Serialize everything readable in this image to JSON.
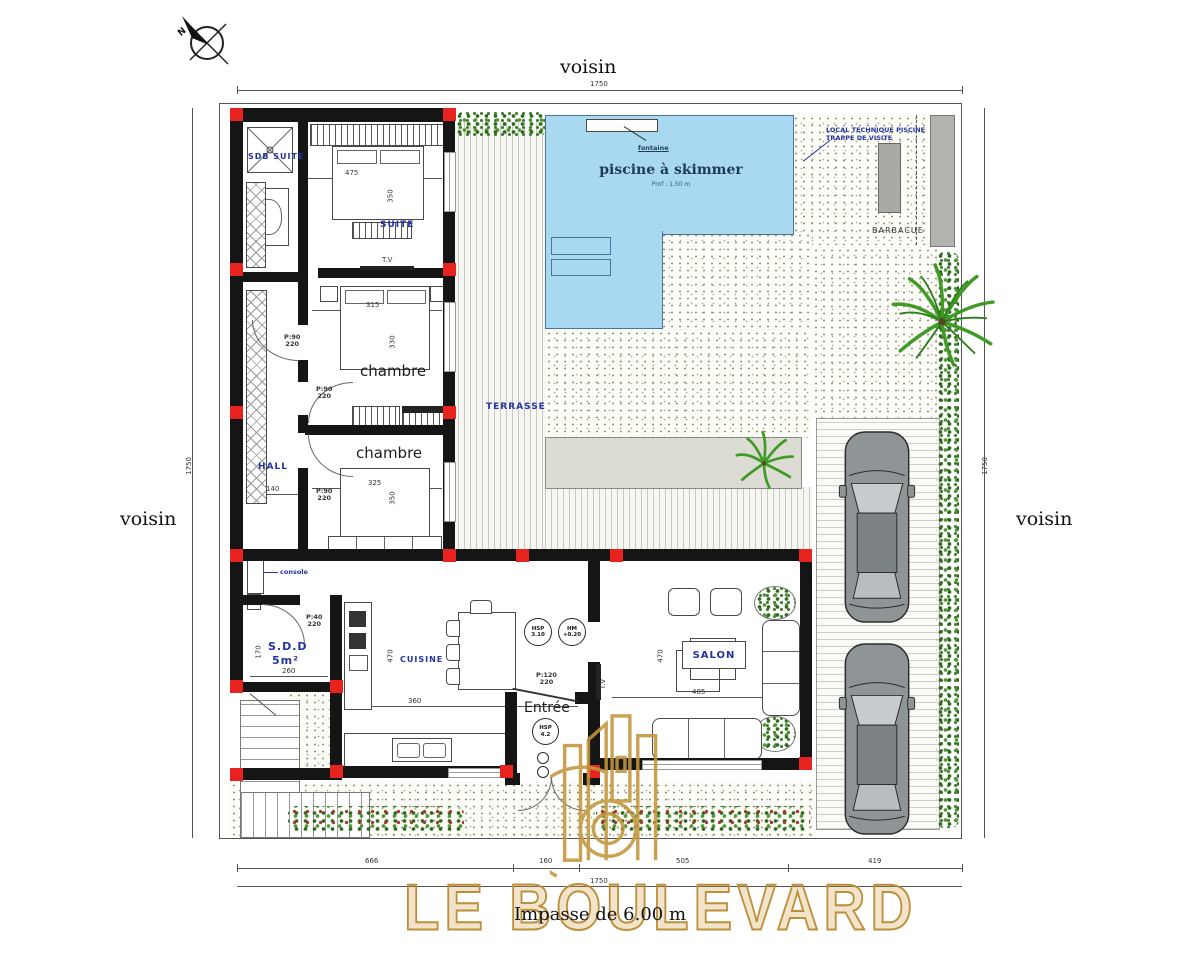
{
  "compass": {
    "label": "N"
  },
  "surroundings": {
    "top": "voisin",
    "left": "voisin",
    "right": "voisin"
  },
  "street": {
    "label": "Impasse de 6.00 m"
  },
  "brand": {
    "name": "LE BOULEVARD"
  },
  "dimensions": {
    "top_total": "1750",
    "bottom_total": "1750",
    "left_total": "1750",
    "right_total": "1750",
    "bottom_segments": {
      "s1": "666",
      "s2": "160",
      "s3": "505",
      "s4": "419"
    }
  },
  "pool": {
    "title": "piscine à skimmer",
    "subtitle": "Prof : 1.50 m",
    "fountain": "fontaine",
    "tech1": "LOCAL TECHNIQUE PISCINE",
    "tech2": "TRAPPE DE VISITE"
  },
  "rooms": {
    "sdb_suite": "SDB SUITE",
    "suite": "SUITE",
    "chambre_1": "chambre",
    "chambre_2": "chambre",
    "hall": "HALL",
    "sdd_1": "S.D.D",
    "sdd_2": "5m²",
    "cuisine": "CUISINE",
    "entree": "Entrée",
    "salon": "SALON",
    "terrasse": "TERRASSE",
    "barbecue": "BARBACUE"
  },
  "annotations": {
    "console": "console",
    "tv": "T.V"
  },
  "dims": {
    "suite_w": "475",
    "suite_h": "350",
    "ch1_w": "315",
    "ch1_h": "330",
    "ch2_w": "325",
    "ch2_h": "350",
    "hall_w": "140",
    "sdd_h": "170",
    "sdd_w": "260",
    "cuisine_h": "470",
    "cuisine_w": "360",
    "salon_h": "470",
    "salon_w": "485"
  },
  "doors": {
    "bedroom": {
      "l1": "P:90",
      "l2": "220"
    },
    "sdd": {
      "l1": "P:40",
      "l2": "220"
    },
    "entree": {
      "l1": "P:120",
      "l2": "220"
    }
  },
  "badges": {
    "entree": {
      "l1": "HSP",
      "l2": "4.2"
    },
    "k1": {
      "l1": "HSP",
      "l2": "3.10"
    },
    "k2": {
      "l1": "HM",
      "l2": "+0.20"
    }
  },
  "colors": {
    "wall": "#151515",
    "column": "#e8231f",
    "label_blue": "#2233a0",
    "pool_fill": "#a9d9f0",
    "gold": "#bd8f3a",
    "hedge_green": "#3c7d28"
  }
}
